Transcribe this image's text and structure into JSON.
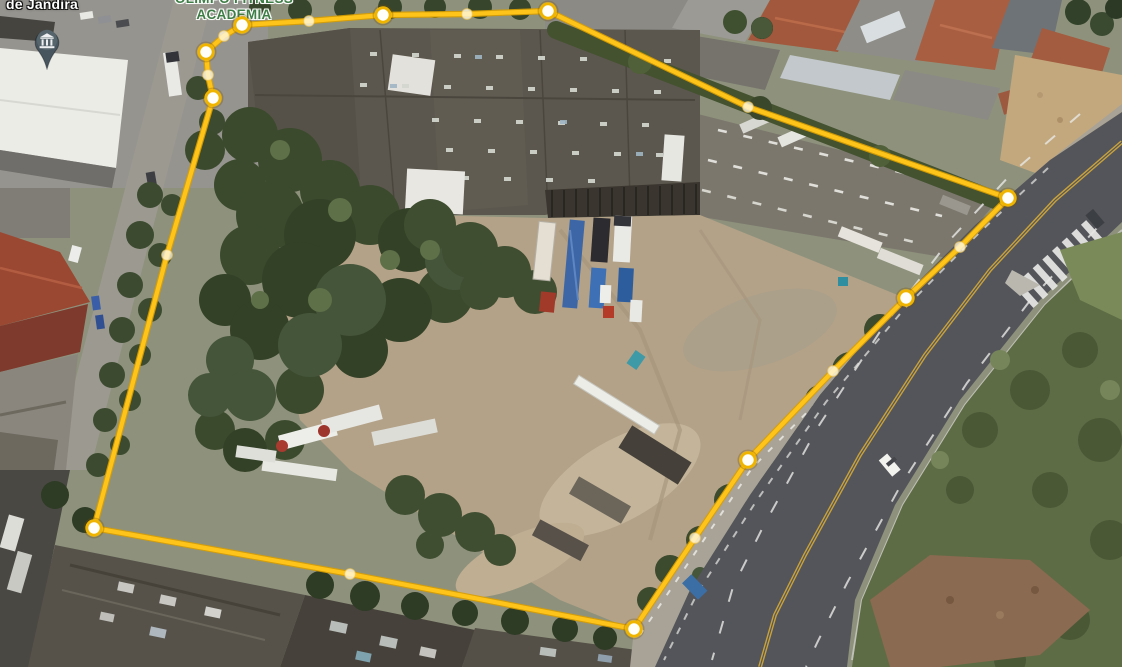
{
  "view": {
    "type": "3d-aerial-satellite-view",
    "tool": "polygon-measure-annotation"
  },
  "labels": {
    "place_partial": "de Jandira",
    "poi_line1": "OLIMPO FITNESS",
    "poi_line2": "ACADEMIA"
  },
  "poi": {
    "pin_icon": "civic-building-pin-icon",
    "pin_color": "#47555E",
    "pin_glyph_color": "#EDEFF0"
  },
  "colors": {
    "polygon_line": "#FFC41A",
    "polygon_line_edge": "#D99E00",
    "vertex_fill": "#FFFEF8",
    "vertex_ring": "#EFB400",
    "midpoint_fill": "rgba(255,250,230,0.78)",
    "midpoint_ring": "rgba(235,190,70,0.55)",
    "poi_label_color": "#3E7D46",
    "place_label_color": "#FFFFFF"
  },
  "measurement_polygon": {
    "closed": true,
    "stroke_width": 4.2,
    "vertices": [
      [
        242,
        25
      ],
      [
        383,
        15
      ],
      [
        548,
        11
      ],
      [
        1008,
        198
      ],
      [
        906,
        298
      ],
      [
        748,
        460
      ],
      [
        634,
        629
      ],
      [
        94,
        528
      ],
      [
        213,
        98
      ],
      [
        206,
        52
      ]
    ],
    "midpoints": [
      [
        309,
        21
      ],
      [
        467,
        14
      ],
      [
        748,
        107
      ],
      [
        960,
        247
      ],
      [
        833,
        371
      ],
      [
        695,
        538
      ],
      [
        350,
        574
      ],
      [
        167,
        255
      ],
      [
        208,
        75
      ],
      [
        224,
        36
      ]
    ],
    "path": [
      [
        242,
        25
      ],
      [
        309,
        21
      ],
      [
        383,
        15
      ],
      [
        467,
        14
      ],
      [
        548,
        11
      ],
      [
        748,
        107
      ],
      [
        1008,
        198
      ],
      [
        960,
        247
      ],
      [
        906,
        298
      ],
      [
        833,
        371
      ],
      [
        748,
        460
      ],
      [
        695,
        538
      ],
      [
        634,
        629
      ],
      [
        350,
        574
      ],
      [
        94,
        528
      ],
      [
        167,
        255
      ],
      [
        213,
        98
      ],
      [
        208,
        75
      ],
      [
        206,
        52
      ],
      [
        224,
        36
      ]
    ]
  }
}
